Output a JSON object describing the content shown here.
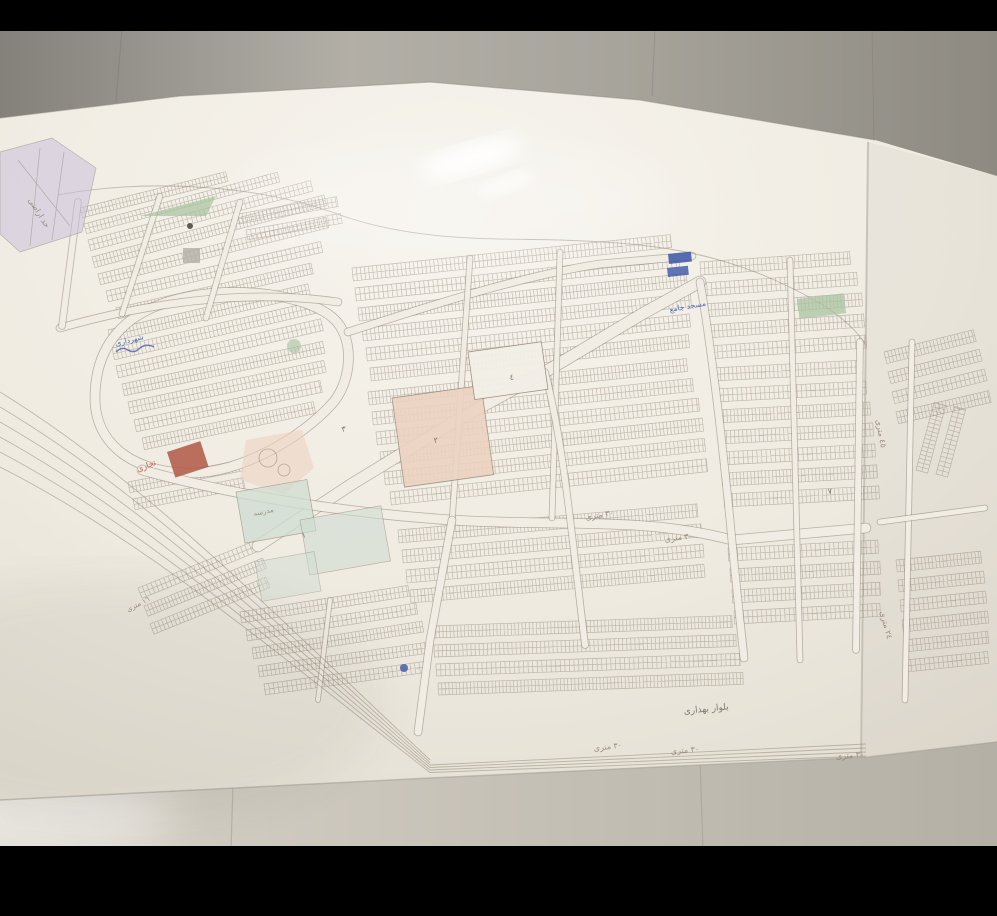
{
  "scene": {
    "title": "hand-drawn cadastral subdivision map photographed on a wall"
  },
  "labels": [
    {
      "id": "street30-a",
      "text": "٣٠ مترى"
    },
    {
      "id": "street30-b",
      "text": "٣٠ مترى"
    },
    {
      "id": "street30-c",
      "text": "٣٠ مترى"
    },
    {
      "id": "street30-d",
      "text": "٣٠ مترى"
    },
    {
      "id": "street30-e",
      "text": "٣٠ مترى"
    },
    {
      "id": "boulevard",
      "text": "بلوار بهدارى"
    },
    {
      "id": "street45",
      "text": "٤٥ مترى"
    },
    {
      "id": "street24",
      "text": "٢٤ مترى"
    },
    {
      "id": "street16",
      "text": "١٦ مترى"
    },
    {
      "id": "red-note",
      "text": "تجارى"
    },
    {
      "id": "blue-note-1",
      "text": "مسجد جامع"
    },
    {
      "id": "blue-note-2",
      "text": "شهردارى"
    },
    {
      "id": "edge-note",
      "text": "حد اراضى"
    },
    {
      "id": "school",
      "text": "مدرسه"
    },
    {
      "id": "num4",
      "text": "٤"
    },
    {
      "id": "num2",
      "text": "٢"
    },
    {
      "id": "num1",
      "text": "١"
    },
    {
      "id": "num7",
      "text": "٧"
    },
    {
      "id": "num3",
      "text": "٣"
    }
  ],
  "colors": {
    "paper": "#f1ede4",
    "paper_shade": "#e3ded2",
    "pencil": "#8d8173",
    "pencil_dark": "#6f6557",
    "ink_blue": "#3c55a8",
    "ink_red": "#b5402e",
    "zone_purple": "#cbc0da",
    "zone_green": "#a6c29e",
    "zone_pink": "#ecd2c0",
    "zone_teal": "#cfdcd2",
    "block_red": "#b05744",
    "wall": "#9b988f",
    "wall_seam": "#7f7d76",
    "floor": "#c8c3b8",
    "highlight": "#ffffff",
    "letterbox": "#000000"
  }
}
